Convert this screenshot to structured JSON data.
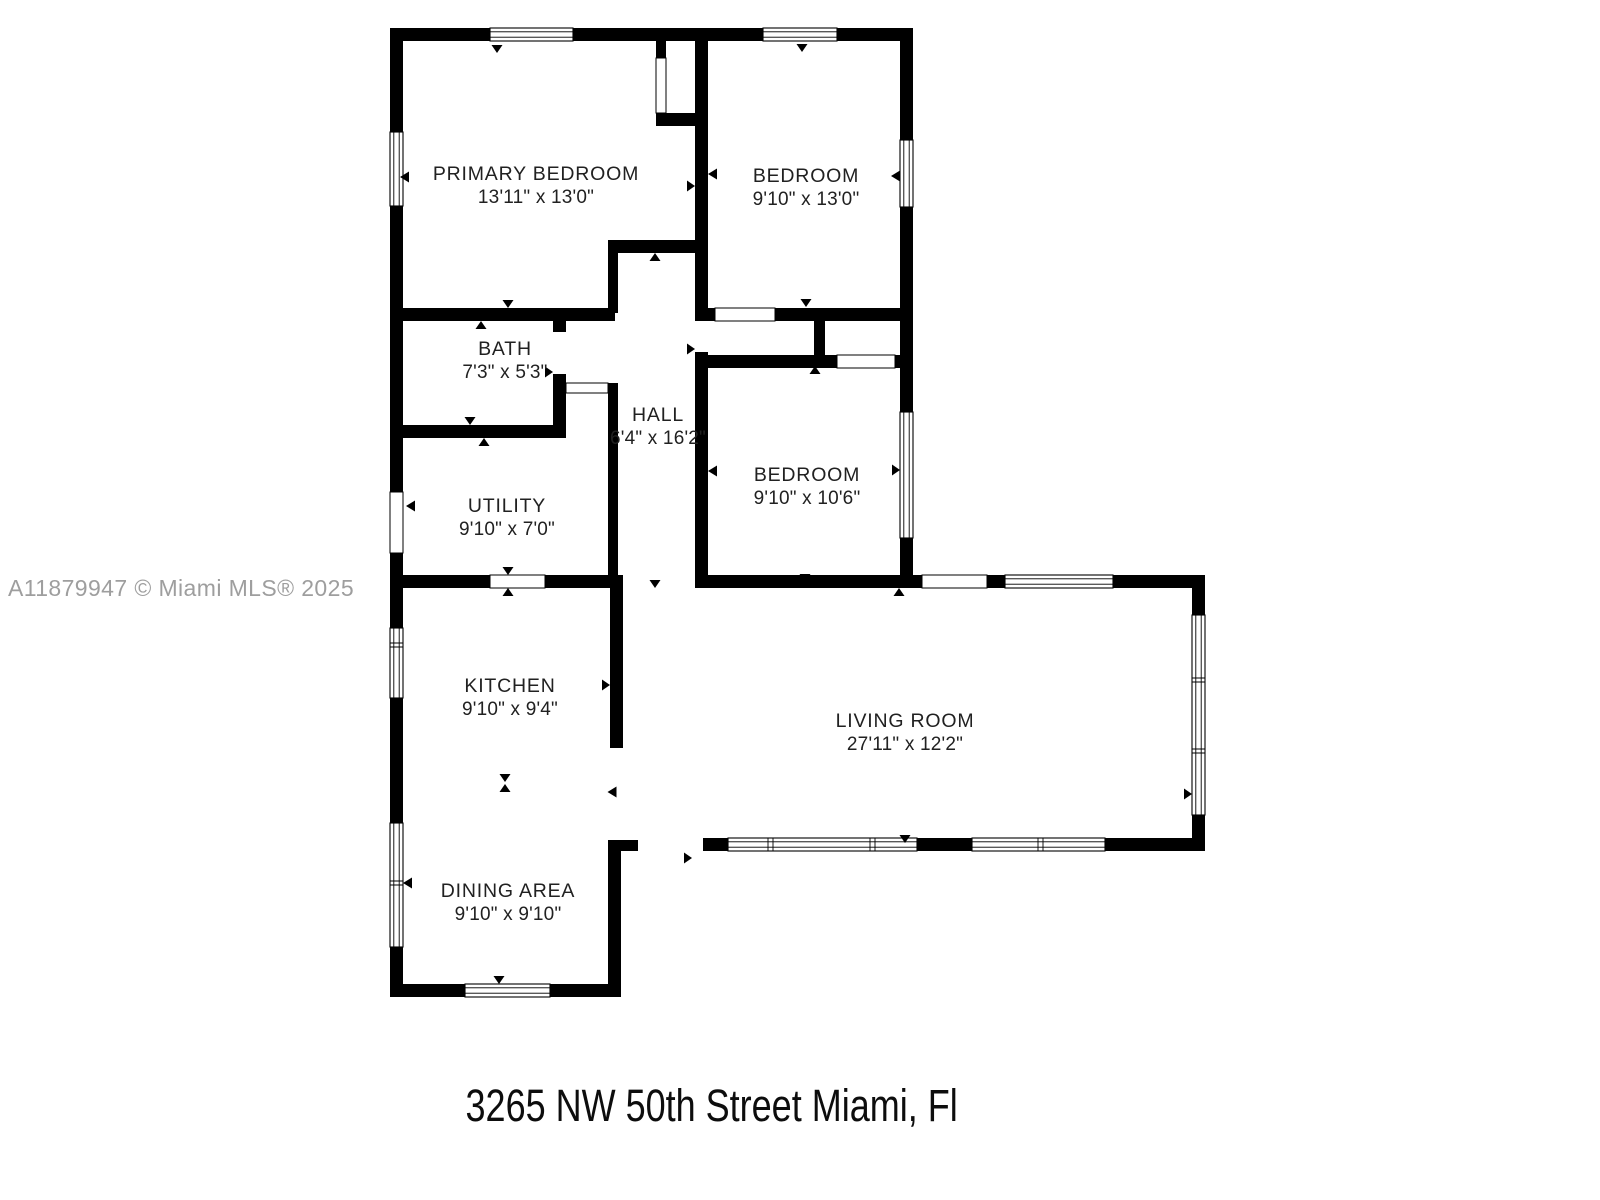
{
  "plan": {
    "type": "floor-plan",
    "watermark": "A11879947 © Miami MLS® 2025",
    "address": "3265 NW 50th Street Miami, Fl"
  },
  "colors": {
    "background": "#ffffff",
    "walls": "#000000",
    "window_fill": "#ffffff",
    "watermark_gray": "#9e9e9e",
    "text": "#212121"
  },
  "rooms": [
    {
      "id": "primary-bedroom",
      "name": "PRIMARY BEDROOM",
      "dimensions": "13'11\" x 13'0\""
    },
    {
      "id": "bedroom-top",
      "name": "BEDROOM",
      "dimensions": "9'10\" x 13'0\""
    },
    {
      "id": "bath",
      "name": "BATH",
      "dimensions": "7'3\" x 5'3\""
    },
    {
      "id": "hall",
      "name": "HALL",
      "dimensions": "6'4\" x 16'2\""
    },
    {
      "id": "bedroom-middle",
      "name": "BEDROOM",
      "dimensions": "9'10\" x 10'6\""
    },
    {
      "id": "utility",
      "name": "UTILITY",
      "dimensions": "9'10\" x 7'0\""
    },
    {
      "id": "kitchen",
      "name": "KITCHEN",
      "dimensions": "9'10\" x 9'4\""
    },
    {
      "id": "living-room",
      "name": "LIVING ROOM",
      "dimensions": "27'11\" x 12'2\""
    },
    {
      "id": "dining-area",
      "name": "DINING AREA",
      "dimensions": "9'10\" x 9'10\""
    }
  ]
}
